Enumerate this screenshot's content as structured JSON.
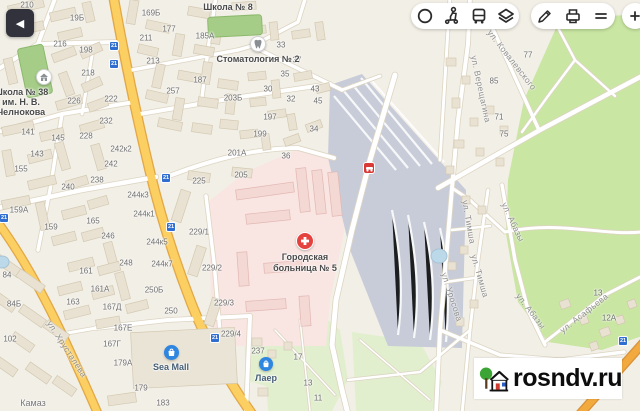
{
  "back_button": {
    "icon": "chevron-left-icon"
  },
  "toolbar": {
    "group1_icons": [
      "traffic-ring-icon",
      "scooter-person-icon",
      "bus-icon",
      "layers-icon"
    ],
    "group2_icons": [
      "pencil-icon",
      "printer-icon",
      "menu-lines-icon"
    ],
    "partial_icon": "plus-tool-icon"
  },
  "watermark": {
    "text": "rosndv.ru",
    "logo": "house-tree-logo"
  },
  "pois": {
    "school8": {
      "label": "Школа № 8"
    },
    "dental": {
      "label": "Стоматология № 2",
      "icon": "tooth-icon"
    },
    "school38": {
      "line1": "Школа № 38",
      "line2": "им. Н. В.",
      "line3": "Челнокова",
      "icon": "school-icon"
    },
    "hospital": {
      "line1": "Городская",
      "line2": "больница № 5",
      "icon": "medical-cross-icon"
    },
    "seamall": {
      "label": "Sea Mall",
      "icon": "shopping-bag-icon"
    },
    "laer": {
      "label": "Лаер",
      "icon": "shopping-bag-icon"
    },
    "kamaz": {
      "label": "Камаз"
    }
  },
  "road_event": {
    "icon": "car-accident-icon",
    "color": "#d93a35"
  },
  "transit_badge_text": "21",
  "transit_badges": [
    [
      114,
      46
    ],
    [
      114,
      64
    ],
    [
      166,
      178
    ],
    [
      171,
      227
    ],
    [
      4,
      218
    ],
    [
      215,
      338
    ],
    [
      623,
      341
    ]
  ],
  "house_numbers": [
    [
      "210",
      27,
      5
    ],
    [
      "19Б",
      77,
      18
    ],
    [
      "169Б",
      151,
      13
    ],
    [
      "216",
      60,
      44
    ],
    [
      "198",
      86,
      50
    ],
    [
      "211",
      146,
      38
    ],
    [
      "213",
      153,
      61
    ],
    [
      "218",
      88,
      73
    ],
    [
      "226",
      74,
      101
    ],
    [
      "222",
      111,
      99
    ],
    [
      "177",
      169,
      29
    ],
    [
      "185А",
      205,
      36
    ],
    [
      "187",
      200,
      80
    ],
    [
      "257",
      173,
      91
    ],
    [
      "203Б",
      233,
      98
    ],
    [
      "197",
      270,
      117
    ],
    [
      "199",
      260,
      134
    ],
    [
      "201А",
      237,
      153
    ],
    [
      "36",
      286,
      156
    ],
    [
      "34",
      314,
      129
    ],
    [
      "33",
      281,
      45
    ],
    [
      "37",
      297,
      60
    ],
    [
      "35",
      285,
      74
    ],
    [
      "30",
      268,
      89
    ],
    [
      "32",
      291,
      99
    ],
    [
      "43",
      315,
      89
    ],
    [
      "45",
      318,
      101
    ],
    [
      "141",
      28,
      132
    ],
    [
      "143",
      37,
      154
    ],
    [
      "145",
      58,
      138
    ],
    [
      "155",
      21,
      169
    ],
    [
      "228",
      86,
      136
    ],
    [
      "232",
      106,
      121
    ],
    [
      "242к2",
      121,
      149
    ],
    [
      "242",
      111,
      164
    ],
    [
      "238",
      97,
      180
    ],
    [
      "240",
      68,
      187
    ],
    [
      "244к3",
      138,
      195
    ],
    [
      "244к1",
      144,
      214
    ],
    [
      "244к5",
      157,
      242
    ],
    [
      "244к7",
      162,
      264
    ],
    [
      "250Б",
      154,
      290
    ],
    [
      "250",
      171,
      311
    ],
    [
      "159А",
      19,
      210
    ],
    [
      "159",
      51,
      227
    ],
    [
      "165",
      93,
      221
    ],
    [
      "246",
      108,
      236
    ],
    [
      "248",
      126,
      263
    ],
    [
      "161",
      86,
      271
    ],
    [
      "161А",
      100,
      289
    ],
    [
      "163",
      73,
      302
    ],
    [
      "167Д",
      112,
      307
    ],
    [
      "167Е",
      123,
      328
    ],
    [
      "167Г",
      112,
      344
    ],
    [
      "84",
      7,
      275
    ],
    [
      "84Б",
      14,
      304
    ],
    [
      "102",
      10,
      339
    ],
    [
      "179А",
      123,
      363
    ],
    [
      "179",
      141,
      388
    ],
    [
      "183",
      163,
      403
    ],
    [
      "225",
      199,
      181
    ],
    [
      "205",
      241,
      175
    ],
    [
      "229/1",
      199,
      232
    ],
    [
      "229/2",
      212,
      268
    ],
    [
      "229/3",
      224,
      303
    ],
    [
      "229/4",
      231,
      334
    ],
    [
      "237",
      258,
      351
    ],
    [
      "17",
      298,
      357
    ],
    [
      "13",
      308,
      383
    ],
    [
      "11",
      318,
      398
    ],
    [
      "77",
      528,
      55
    ],
    [
      "85",
      494,
      81
    ],
    [
      "71",
      499,
      117
    ],
    [
      "75",
      504,
      134
    ],
    [
      "13",
      598,
      293
    ],
    [
      "12А",
      609,
      318
    ]
  ],
  "street_labels": [
    [
      "ул. Хрусталёва",
      67,
      349,
      57
    ],
    [
      "ул. Ковалевского",
      512,
      60,
      52
    ],
    [
      "ул. Верещагина",
      481,
      89,
      78
    ],
    [
      "ул. Абазы",
      513,
      222,
      65
    ],
    [
      "ул. Абазы",
      531,
      311,
      52
    ],
    [
      "ул. Тимша",
      469,
      222,
      80
    ],
    [
      "ул. Тимша",
      480,
      276,
      74
    ],
    [
      "ул. Уросова",
      452,
      297,
      72
    ],
    [
      "ул. Асафьева",
      584,
      313,
      -38
    ]
  ],
  "colors": {
    "background": "#f2efe6",
    "road_yellow": "#fccf63",
    "road_orange": "#f2a93d",
    "park_green": "#c9e6a2",
    "garden_green": "#e2efcf",
    "hospital_area_pink": "#f9e5e2",
    "industrial_gray": "#c8ccd8",
    "poi_blue": "#2e86e0",
    "hospital_red": "#e5413e",
    "badge_blue": "#2f6ed0"
  }
}
